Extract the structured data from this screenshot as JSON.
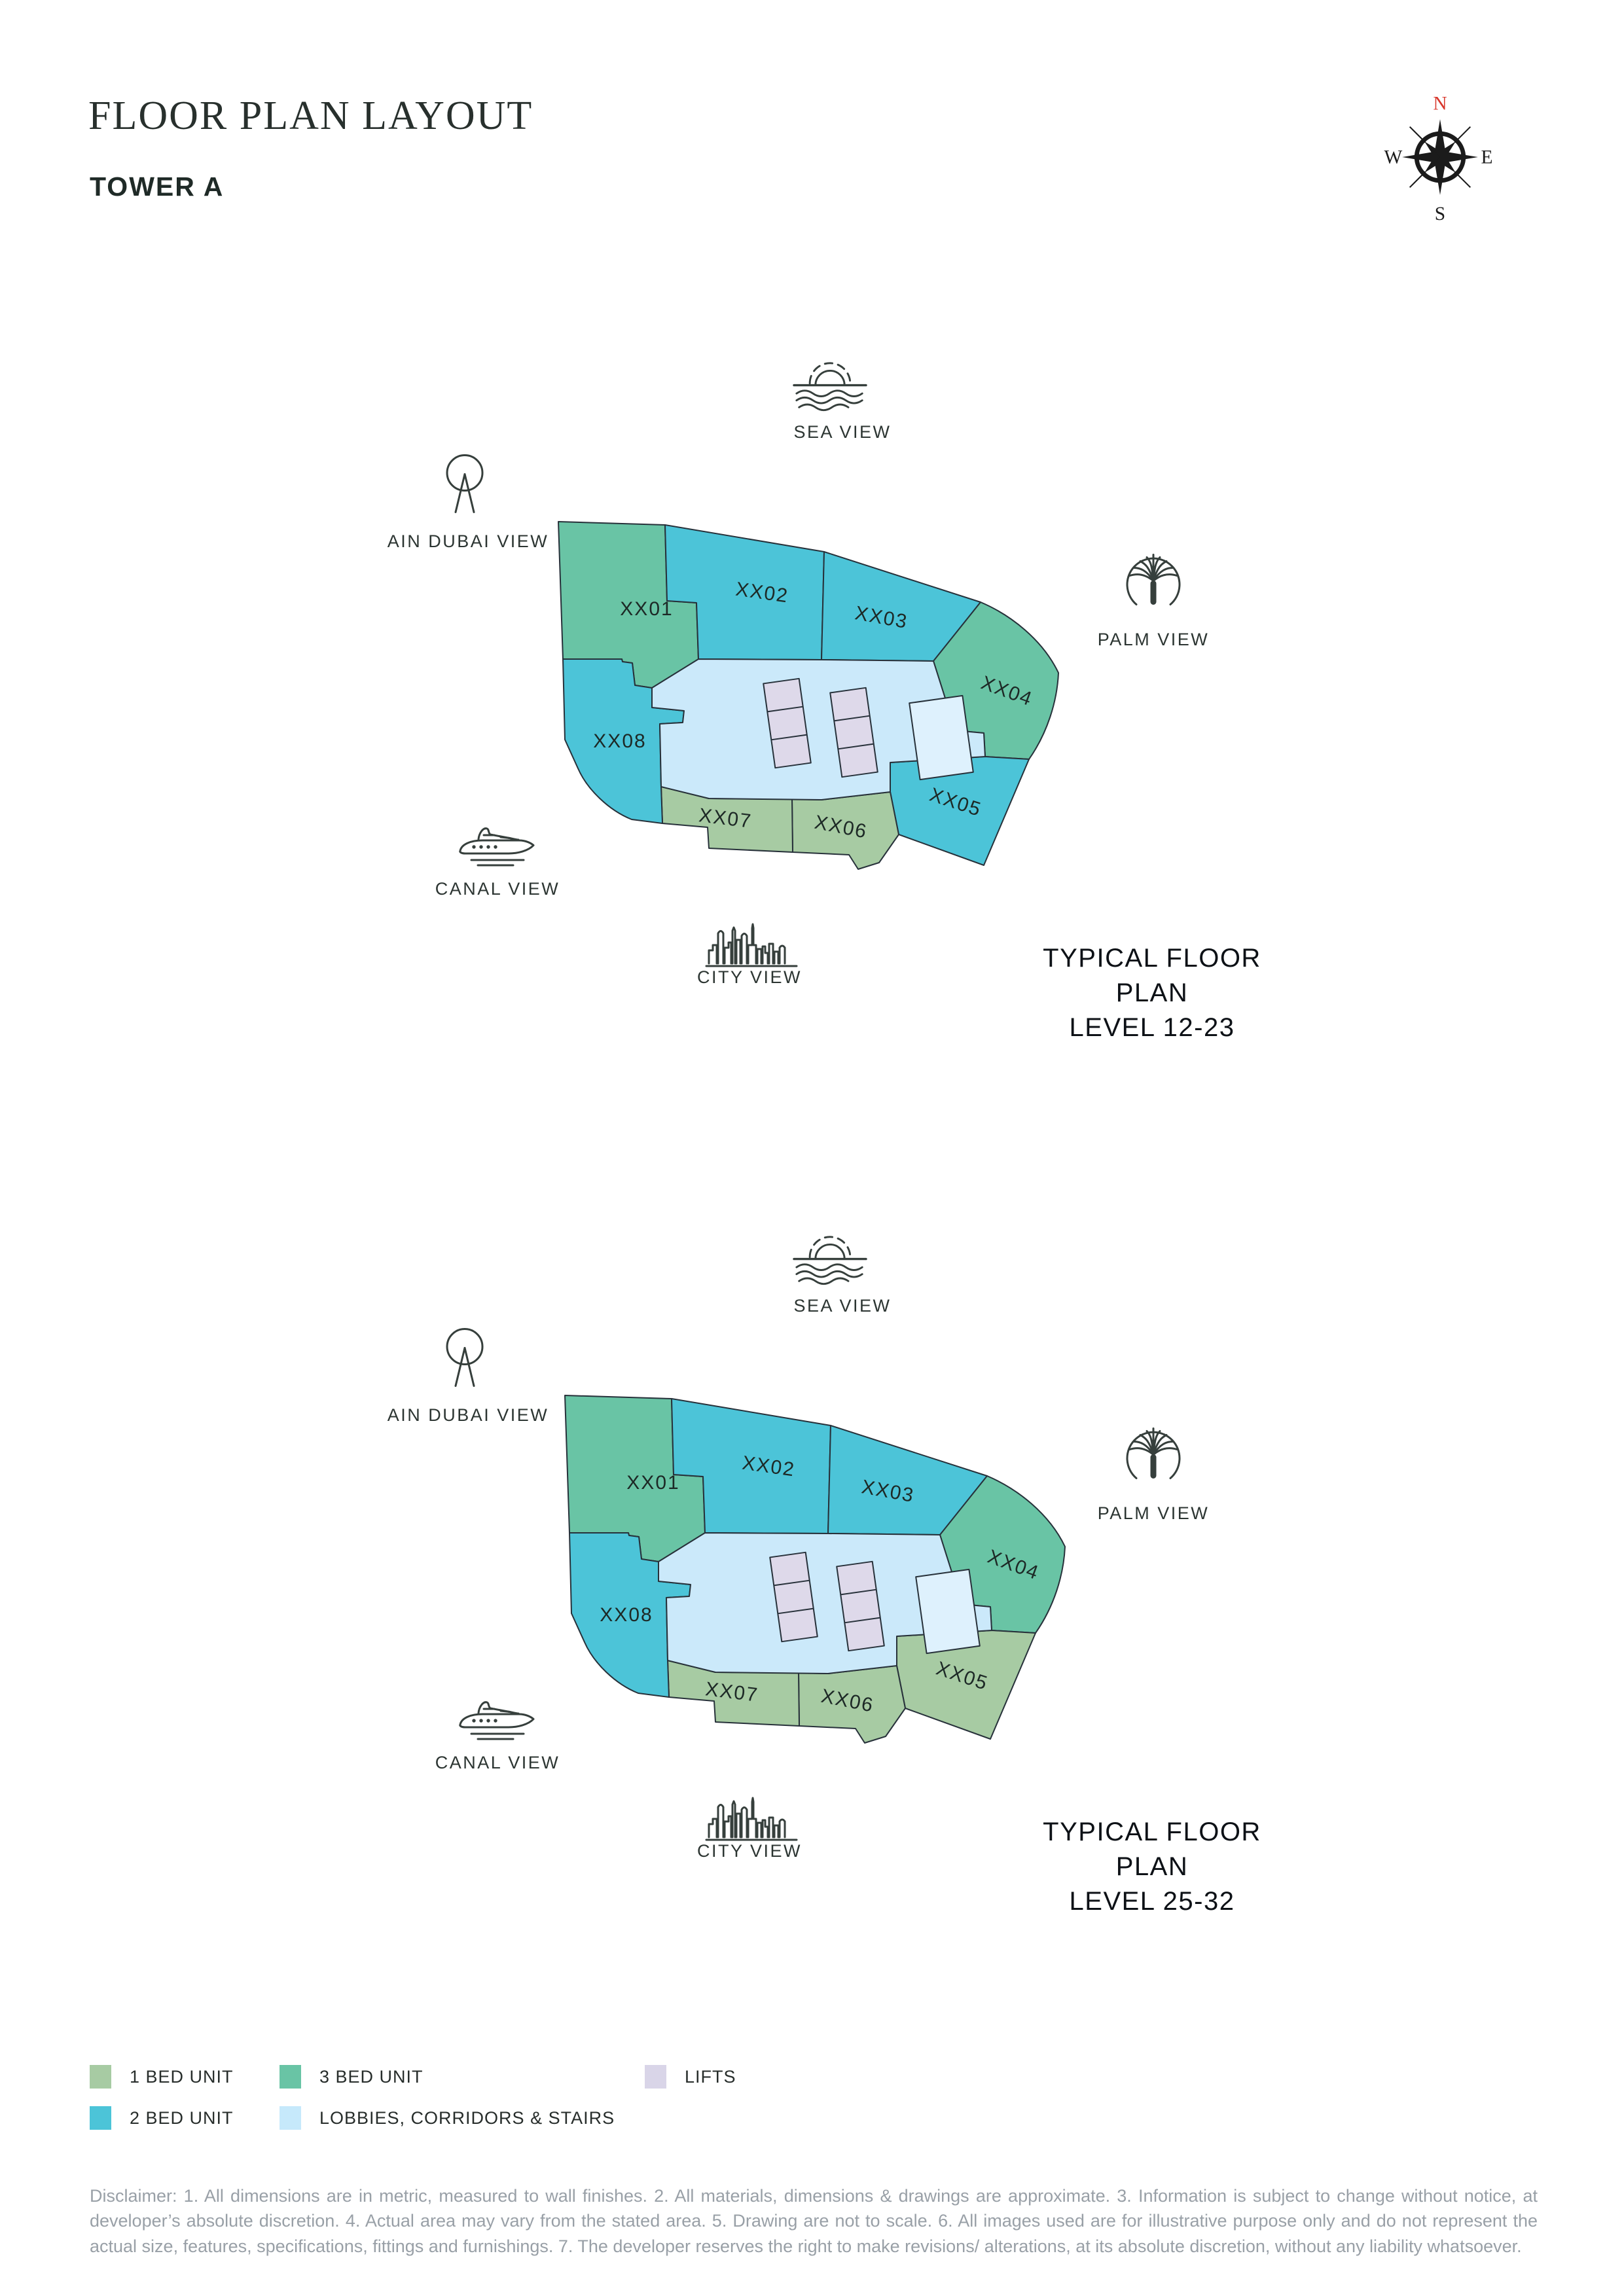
{
  "page": {
    "title": "FLOOR PLAN LAYOUT",
    "subtitle": "TOWER A"
  },
  "compass": {
    "north": "N",
    "east": "E",
    "south": "S",
    "west": "W",
    "north_color": "#d8372c"
  },
  "colors": {
    "1-bed": "#a7cba3",
    "2-bed": "#4cc4d8",
    "3-bed": "#69c4a5",
    "corridor": "#cbe9fa",
    "stair": "#def1fd",
    "lift": "#ded9ea"
  },
  "plans": [
    {
      "caption_line1": "TYPICAL FLOOR PLAN",
      "caption_line2": "LEVEL 12-23",
      "views": {
        "sea": "SEA VIEW",
        "ain_dubai": "AIN DUBAI VIEW",
        "palm": "PALM VIEW",
        "canal": "CANAL VIEW",
        "city": "CITY VIEW"
      },
      "units": [
        {
          "id": "XX01",
          "type": "3-bed"
        },
        {
          "id": "XX02",
          "type": "2-bed"
        },
        {
          "id": "XX03",
          "type": "2-bed"
        },
        {
          "id": "XX04",
          "type": "3-bed"
        },
        {
          "id": "XX05",
          "type": "2-bed"
        },
        {
          "id": "XX06",
          "type": "1-bed"
        },
        {
          "id": "XX07",
          "type": "1-bed"
        },
        {
          "id": "XX08",
          "type": "2-bed"
        }
      ]
    },
    {
      "caption_line1": "TYPICAL FLOOR PLAN",
      "caption_line2": "LEVEL 25-32",
      "views": {
        "sea": "SEA VIEW",
        "ain_dubai": "AIN DUBAI VIEW",
        "palm": "PALM VIEW",
        "canal": "CANAL VIEW",
        "city": "CITY VIEW"
      },
      "units": [
        {
          "id": "XX01",
          "type": "3-bed"
        },
        {
          "id": "XX02",
          "type": "2-bed"
        },
        {
          "id": "XX03",
          "type": "2-bed"
        },
        {
          "id": "XX04",
          "type": "3-bed"
        },
        {
          "id": "XX05",
          "type": "1-bed"
        },
        {
          "id": "XX06",
          "type": "1-bed"
        },
        {
          "id": "XX07",
          "type": "1-bed"
        },
        {
          "id": "XX08",
          "type": "2-bed"
        }
      ]
    }
  ],
  "legend": {
    "items": [
      {
        "label": "1 BED UNIT",
        "color": "#a7cba3"
      },
      {
        "label": "3 BED UNIT",
        "color": "#69c4a5"
      },
      {
        "label": "LIFTS",
        "color": "#d9d5e8"
      },
      {
        "label": "2 BED UNIT",
        "color": "#4cc4d8"
      },
      {
        "label": "LOBBIES, CORRIDORS & STAIRS",
        "color": "#c6e9fb"
      }
    ]
  },
  "disclaimer": "Disclaimer: 1. All dimensions are in metric, measured to wall finishes. 2. All materials, dimensions & drawings are approximate. 3. Information is subject to change without notice, at developer’s absolute discretion. 4. Actual area may vary from the stated area. 5. Drawing are not to scale. 6. All images used are for illustrative purpose only and do not represent the actual size, features, specifications, fittings and furnishings. 7. The developer reserves the right to make revisions/ alterations, at its absolute discretion, without any liability whatsoever."
}
